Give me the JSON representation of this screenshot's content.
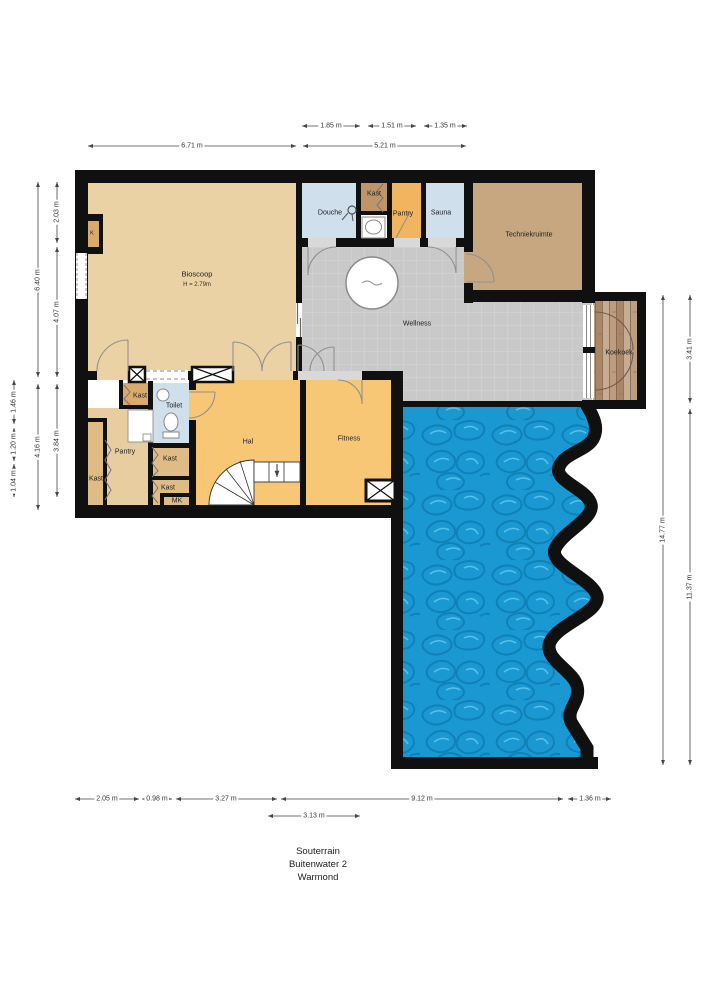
{
  "title": {
    "line1": "Souterrain",
    "line2": "Buitenwater 2",
    "line3": "Warmond"
  },
  "rooms": {
    "bioscoop": {
      "label": "Bioscoop",
      "height_note": "H = 2.79m"
    },
    "k": {
      "label": "K"
    },
    "douche": {
      "label": "Douche"
    },
    "kast_top": {
      "label": "Kast"
    },
    "pantry_top": {
      "label": "Pantry"
    },
    "sauna": {
      "label": "Sauna"
    },
    "techniekruimte": {
      "label": "Techniekruimte"
    },
    "wellness": {
      "label": "Wellness"
    },
    "koekoek": {
      "label": "Koekoek"
    },
    "kast_a": {
      "label": "Kast"
    },
    "toilet": {
      "label": "Toilet"
    },
    "pantry_left": {
      "label": "Pantry"
    },
    "kast_left": {
      "label": "Kast"
    },
    "kast_mid": {
      "label": "Kast"
    },
    "kast_low": {
      "label": "Kast"
    },
    "mk": {
      "label": "MK"
    },
    "hal": {
      "label": "Hal"
    },
    "fitness": {
      "label": "Fitness"
    }
  },
  "dimensions": {
    "top_row1": [
      "1.85 m",
      "1.51 m",
      "1.35 m"
    ],
    "top_row2": [
      "6.71 m",
      "5.21 m"
    ],
    "left_outer": [
      "1.46 m",
      "1.20 m",
      "1.04 m"
    ],
    "left_mid": [
      "6.40 m",
      "4.16 m"
    ],
    "left_inner": [
      "2.03 m",
      "4.07 m",
      "3.84 m"
    ],
    "right_inner": [
      "14.77 m"
    ],
    "right_outer": [
      "3.41 m",
      "11.37 m"
    ],
    "bottom_row1": [
      "2.05 m",
      "0.98 m",
      "3.27 m",
      "9.12 m",
      "1.36 m"
    ],
    "bottom_row2": [
      "3.13 m"
    ]
  },
  "colors": {
    "wall": "#101010",
    "room_tan": "#ebd2a4",
    "room_orange": "#f7c775",
    "room_orange_deep": "#f1b55f",
    "room_blue": "#cfdfec",
    "room_brown": "#bf9468",
    "room_taupe": "#c7a77f",
    "room_tan_dark": "#d9aa6b",
    "kast_tan": "#dfbc85",
    "wellness_gray": "#c9c9c9",
    "pool_blue": "#1a98d2",
    "wood": "#b5947a"
  }
}
